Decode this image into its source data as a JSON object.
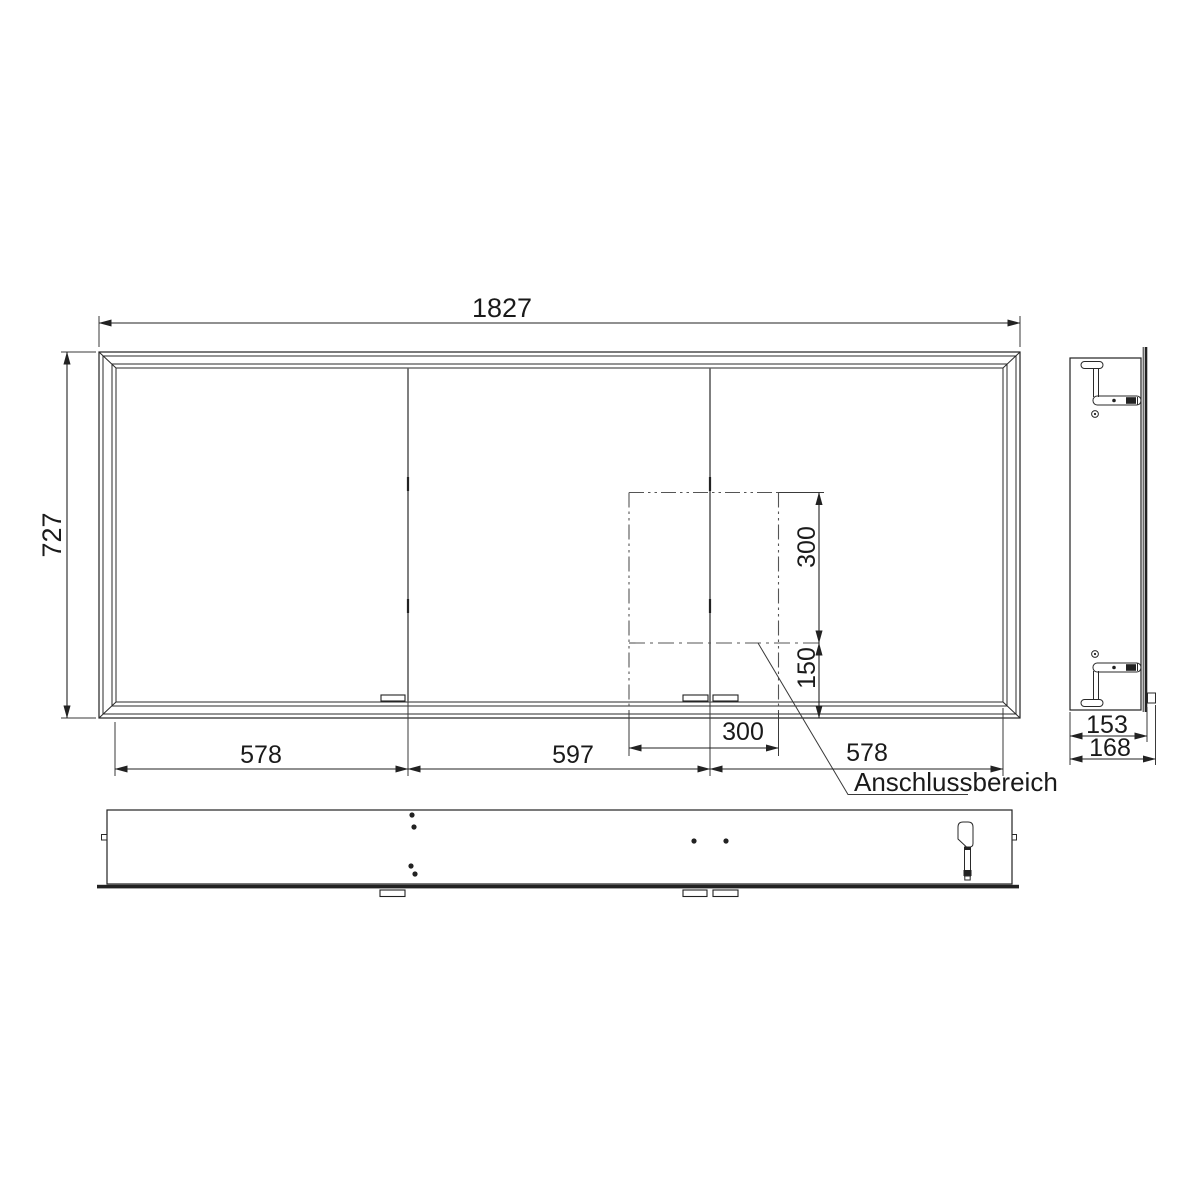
{
  "colors": {
    "line": "#222222",
    "divider": "#5f5f5f",
    "background": "#ffffff"
  },
  "front_view": {
    "dim_total_width": "1827",
    "dim_total_height": "727",
    "dim_door_left": "578",
    "dim_door_middle": "597",
    "dim_door_right": "578"
  },
  "connection_area": {
    "label": "Anschlussbereich",
    "dim_width": "300",
    "dim_height_above": "300",
    "dim_offset_bottom": "150"
  },
  "side_view": {
    "dim_depth_without_door": "153",
    "dim_depth_total": "168"
  }
}
